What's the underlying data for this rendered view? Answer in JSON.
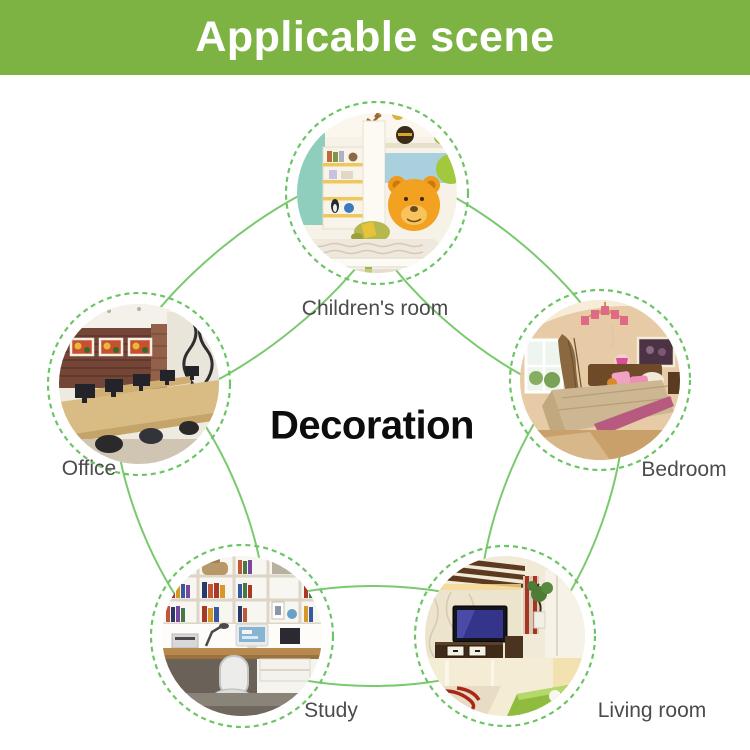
{
  "header": {
    "title": "Applicable scene"
  },
  "center": {
    "title": "Decoration"
  },
  "nodes": [
    {
      "id": "children-room",
      "label": "Children's room"
    },
    {
      "id": "office",
      "label": "Office"
    },
    {
      "id": "bedroom",
      "label": "Bedroom"
    },
    {
      "id": "study",
      "label": "Study"
    },
    {
      "id": "living-room",
      "label": "Living room"
    }
  ],
  "colors": {
    "banner_green": "#7cb342",
    "banner_text": "#ffffff",
    "arc_green": "#7ac96f",
    "ring_green": "#6cc465",
    "label_text": "#4b4b4b",
    "center_text": "#0d0d0d"
  }
}
